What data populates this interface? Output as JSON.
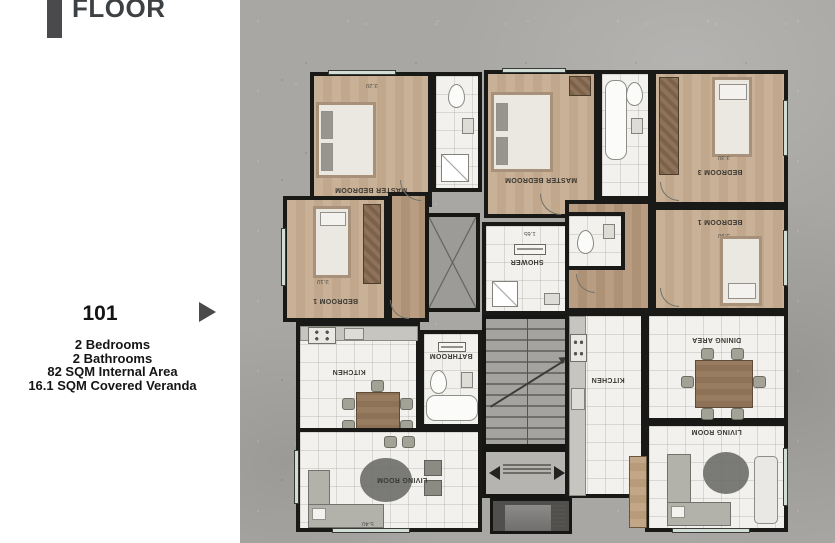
{
  "sidebar": {
    "floor_label": "FLOOR",
    "unit_number": "101",
    "detail_lines": [
      "2 Bedrooms",
      "2 Bathrooms",
      "82 SQM Internal Area",
      "16.1 SQM Covered Veranda"
    ],
    "accent_color": "#4a4a4c"
  },
  "floorplan": {
    "labels": {
      "left_master_bedroom": "MASTER BEDROOM",
      "left_bedroom1": "BEDROOM 1",
      "left_kitchen": "KITCHEN",
      "left_bathroom": "BATHROOM",
      "left_living_room": "LIVING ROOM",
      "shower": "SHOWER",
      "right_master_bedroom": "MASTER BEDROOM",
      "right_bedroom3": "BEDROOM 3",
      "right_bedroom1": "BEDROOM 1",
      "right_kitchen": "KITCHEN",
      "right_dining_area": "DINING AREA",
      "right_living_room": "LIVING ROOM"
    },
    "dimensions": {
      "d1": "3.20",
      "d2": "3.30",
      "d3": "3.90",
      "d4": "1.65",
      "d5": "3.10",
      "d6": "5.40"
    },
    "colors": {
      "background_concrete": "#a8a7a4",
      "wall": "#191918",
      "wood_floor": "#c9b197",
      "tile_floor": "#f2f1ee",
      "window": "#d2ddd8"
    }
  }
}
